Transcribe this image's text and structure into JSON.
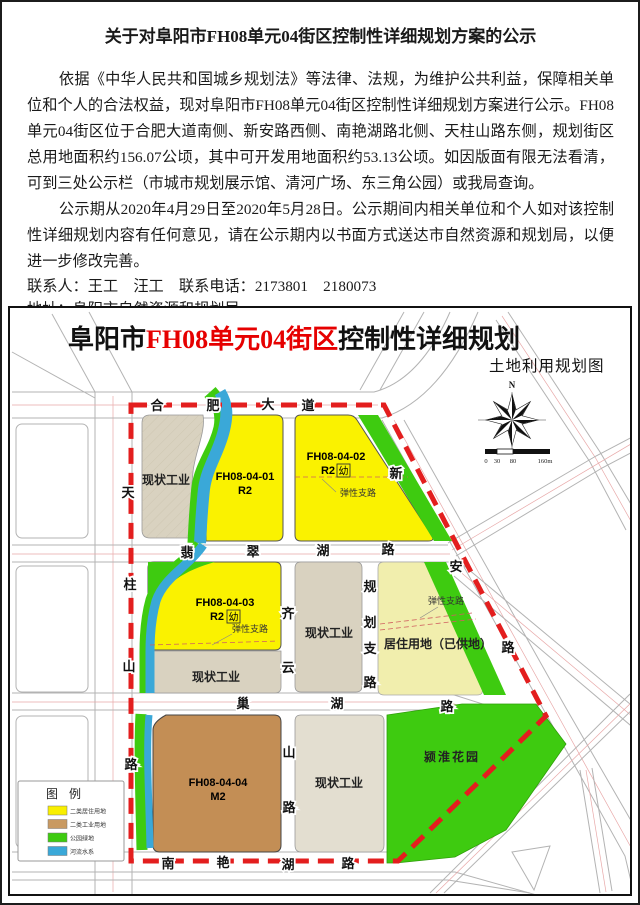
{
  "doc": {
    "title": "关于对阜阳市FH08单元04街区控制性详细规划方案的公示",
    "para1": "依据《中华人民共和国城乡规划法》等法律、法规，为维护公共利益，保障相关单位和个人的合法权益，现对阜阳市FH08单元04街区控制性详细规划方案进行公示。FH08单元04街区位于合肥大道南侧、新安路西侧、南艳湖路北侧、天柱山路东侧，规划街区总用地面积约156.07公顷，其中可开发用地面积约53.13公顷。如因版面有限无法看清，可到三处公示栏（市城市规划展示馆、清河广场、东三角公园）或我局查询。",
    "para2": "公示期从2020年4月29日至2020年5月28日。公示期间内相关单位和个人如对该控制性详细规划内容有任何意见，请在公示期内以书面方式送达市自然资源和规划局，以便进一步修改完善。",
    "contact_line": "联系人：王工　汪工　联系电话：2173801　2180073",
    "address_line": "地址：阜阳市自然资源和规划局",
    "website_line": "登陆网站:http://zrgh.fy.gov.cn/",
    "date": "2020年4月29日"
  },
  "map": {
    "title": {
      "prefix": "阜阳市",
      "highlight": "FH08单元04街区",
      "suffix": "控制性详细规划"
    },
    "highlight_color": "#e60000",
    "subtitle": "土地利用规划图",
    "north_label": "N",
    "scale": {
      "t0": "0",
      "t30": "30",
      "t80": "80",
      "t160": "160m"
    },
    "legend": {
      "title": "图 例",
      "items": [
        {
          "label": "二类居住用地",
          "color": "#f9ef00"
        },
        {
          "label": "二类工业用地",
          "color": "#c99a62"
        },
        {
          "label": "公园绿地",
          "color": "#3ecb10"
        },
        {
          "label": "河流水系",
          "color": "#3aa8d8"
        }
      ]
    },
    "parcels": {
      "p1": "现状工业",
      "p2_code": "FH08-04-01",
      "p2_use": "R2",
      "p3_code": "FH08-04-02",
      "p3_use": "R2",
      "p3_kind": "幼",
      "p3_note": "弹性支路",
      "p4_code": "FH08-04-03",
      "p4_use": "R2",
      "p4_kind": "幼",
      "p4_note": "弹性支路",
      "p5": "现状工业",
      "p6": "现状工业",
      "p7": "居住用地（已供地）",
      "p7_note": "弹性支路",
      "p8_code": "FH08-04-04",
      "p8_use": "M2",
      "p9": "现状工业",
      "p10": "颍淮花园"
    },
    "roads": {
      "hefeidadao": [
        "合",
        "肥",
        "大",
        "道"
      ],
      "feicuihulu": [
        "翡",
        "翠",
        "湖",
        "路"
      ],
      "chaohulu": [
        "巢",
        "湖",
        "路"
      ],
      "nanyanhulu": [
        "南",
        "艳",
        "湖",
        "路"
      ],
      "tianzhushanlu": [
        "天",
        "柱",
        "山",
        "路"
      ],
      "qiyunshanlu": [
        "齐",
        "云",
        "山",
        "路"
      ],
      "guihuazhilu": [
        "规",
        "划",
        "支",
        "路"
      ],
      "xinanlu": [
        "新",
        "安",
        "路"
      ]
    }
  }
}
